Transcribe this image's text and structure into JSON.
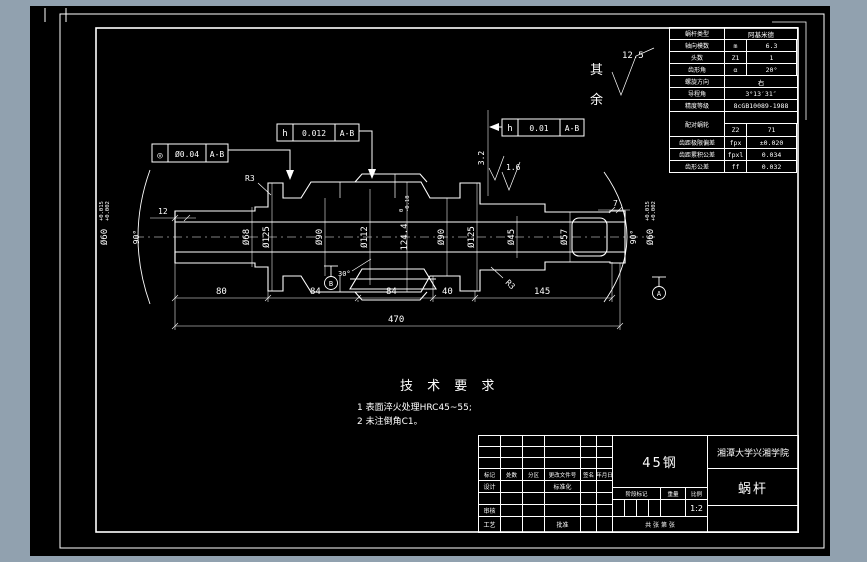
{
  "drawing": {
    "tech_requirements": {
      "title": "技 术 要 求",
      "line1": "1 表面淬火处理HRC45~55;",
      "line2": "2 未注倒角C1。"
    },
    "surface_note": {
      "char1": "其",
      "char2": "余",
      "value": "12.5"
    },
    "roughness": {
      "worm_flank": "3.2",
      "worm_crest": "1.6"
    },
    "tolerance_frames": {
      "concentricity": {
        "symbol": "◎",
        "value": "Ø0.04",
        "datum": "A-B"
      },
      "runout_worm": {
        "symbol": "h",
        "value": "0.012",
        "datum": "A-B"
      },
      "runout_journal": {
        "symbol": "h",
        "value": "0.01",
        "datum": "A-B"
      }
    },
    "datums": {
      "a": "A",
      "b": "B"
    },
    "dims": {
      "d60_left": {
        "main": "Ø60",
        "upper": "+0.015",
        "lower": "+0.002"
      },
      "d60_right": {
        "main": "Ø60",
        "upper": "+0.015",
        "lower": "+0.002"
      },
      "d68": "Ø68",
      "d125_left": "Ø125",
      "d90_left": "Ø90",
      "d112": "Ø112",
      "d124": {
        "main": "124.4",
        "upper": "0",
        "lower": "-0.18"
      },
      "d90_right": "Ø90",
      "d125_right": "Ø125",
      "d45": "Ø45",
      "d57": "Ø57",
      "len12": "12",
      "len7": "7",
      "chain": [
        "80",
        "84",
        "84",
        "40",
        "145"
      ],
      "total": "470",
      "r3_left": "R3",
      "r3_right": "R3",
      "angle_left": "90°",
      "angle_right": "90°",
      "angle_30": "30°"
    }
  },
  "param_table": {
    "rows": [
      {
        "label": "蜗杆类型",
        "symbol": "",
        "value": "阿基米德"
      },
      {
        "label": "轴向模数",
        "symbol": "m",
        "value": "6.3"
      },
      {
        "label": "头数",
        "symbol": "Z1",
        "value": "1"
      },
      {
        "label": "齿形角",
        "symbol": "α",
        "value": "20°"
      },
      {
        "label": "螺旋方向",
        "symbol": "",
        "value": "右"
      },
      {
        "label": "导程角",
        "symbol": "",
        "value": "3°13′31″"
      },
      {
        "label": "精度等级",
        "symbol": "",
        "value": "8cGB10089-1988"
      },
      {
        "label": "配对蜗轮",
        "symbol": "Z2",
        "value": "71"
      },
      {
        "label": "齿距极限偏差",
        "symbol": "fpx",
        "value": "±0.020"
      },
      {
        "label": "齿距累积公差",
        "symbol": "fpxl",
        "value": "0.034"
      },
      {
        "label": "齿形公差",
        "symbol": "ff",
        "value": "0.032"
      }
    ]
  },
  "title_block": {
    "material": "45钢",
    "company": "湘潭大学兴湘学院",
    "part_name": "蜗杆",
    "scale_value": "1:2",
    "labels": {
      "mark": "标记",
      "count": "处数",
      "zone": "分区",
      "change_doc": "更改文件号",
      "sign": "签名",
      "date": "年月日",
      "design": "设计",
      "standardize": "标准化",
      "review": "审核",
      "process": "工艺",
      "approve": "批准",
      "stage_mark": "阶段标记",
      "weight": "重量",
      "scale": "比例",
      "sheet_info": "共 张 第 张"
    }
  }
}
